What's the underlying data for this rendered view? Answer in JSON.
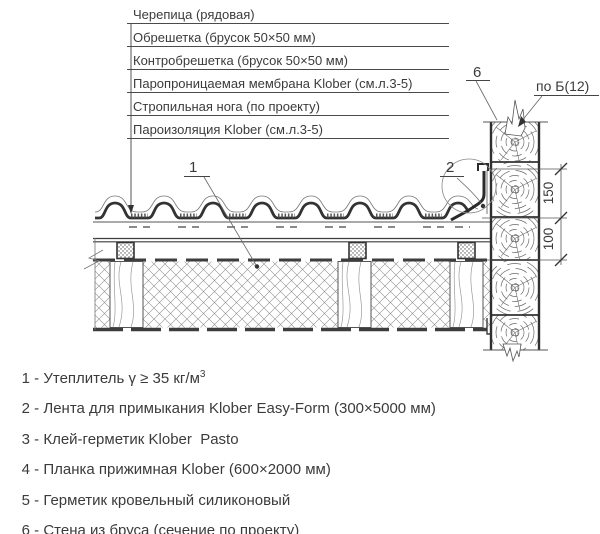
{
  "colors": {
    "background": "#ffffff",
    "line": "#3d3d3d",
    "text": "#3b3b3b"
  },
  "layer_callouts": {
    "items": [
      "Черепица (рядовая)",
      "Обрешетка (брусок 50×50 мм)",
      "Контробрешетка (брусок 50×50 мм)",
      "Паропроницаемая мембрана Klober (см.л.3-5)",
      "Стропильная нога (по проекту)",
      "Пароизоляция Klober (см.л.3-5)"
    ]
  },
  "drawing_callouts": {
    "insulation": "1",
    "tape": "2",
    "wall": "6",
    "section_view": "по Б(12)"
  },
  "dimensions": {
    "upper": "150",
    "lower": "100"
  },
  "legend": {
    "items": [
      {
        "text": "1 - Утеплитель γ ≥ 35 кг/м",
        "sup": "3"
      },
      {
        "text": "2 - Лента для примыкания Klober Easy-Form (300×5000 мм)"
      },
      {
        "text": "3 - Клей-герметик Klober  Pasto"
      },
      {
        "text": "4 - Планка прижимная Klober (600×2000 мм)"
      },
      {
        "text": "5 - Герметик кровельный силиконовый"
      },
      {
        "text": "6 - Стена из бруса (сечение по проекту)"
      }
    ]
  }
}
